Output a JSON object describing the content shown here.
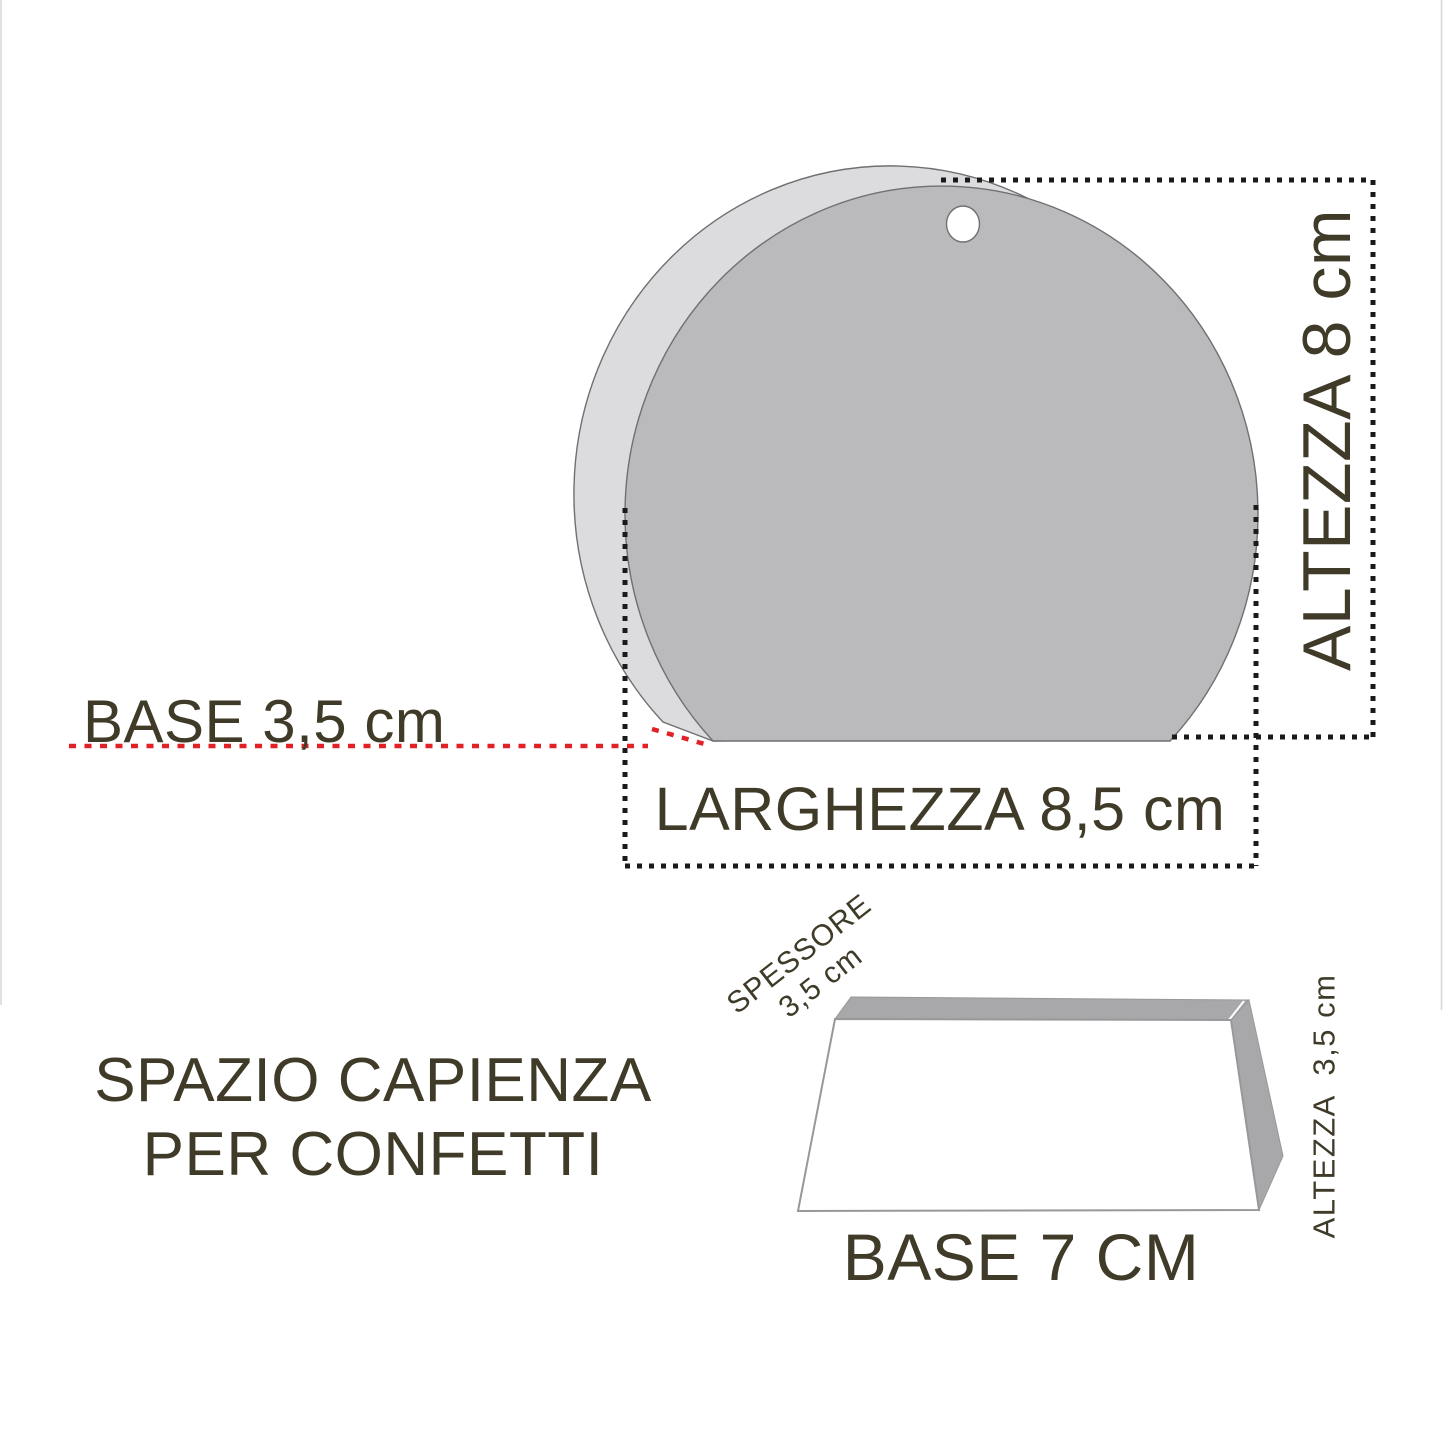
{
  "diagram": {
    "top_shape": {
      "label_height": "ALTEZZA 8 cm",
      "label_base": "BASE 3,5 cm",
      "label_width": "LARGHEZZA 8,5 cm"
    },
    "bottom_shape": {
      "title_line1": "SPAZIO CAPIENZA",
      "title_line2": "PER CONFETTI",
      "label_thickness_line1": "SPESSORE",
      "label_thickness_line2": "3,5 cm",
      "label_height": "ALTEZZA  3,5 cm",
      "label_base": "BASE 7 CM"
    },
    "colors": {
      "label_text": "#3F3B28",
      "dimension_line": "#1A1A1A",
      "base_dimension_line_red": "#E22127",
      "disc_front_fill": "#BABABC",
      "disc_back_fill": "#DCDCDE",
      "disc_outline": "#707072",
      "prism_face_fill": "#A8A8AA",
      "prism_front_fill": "#FFFFFF",
      "prism_outline": "#98989A"
    }
  }
}
